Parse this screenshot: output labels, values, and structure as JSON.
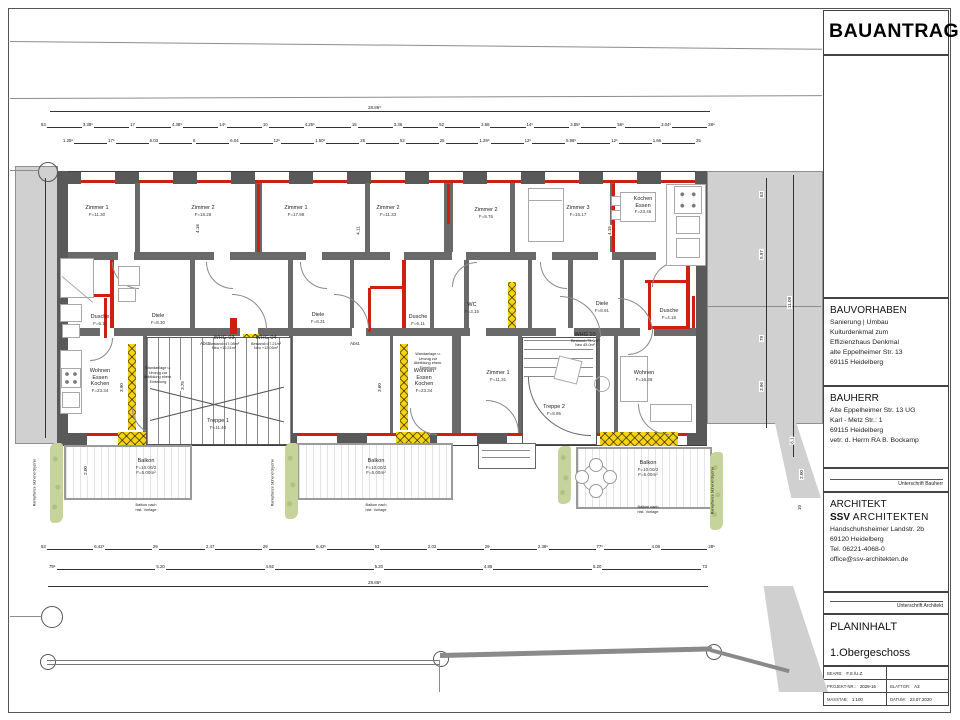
{
  "colors": {
    "wall": "#595959",
    "new_wall_red": "#cf1f10",
    "demolition_yellow": "#f6d412",
    "neighbor_gray": "#d0d0d0",
    "plant_green": "#c6d49c"
  },
  "title_block": {
    "title": "BAUANTRAG",
    "bauvorhaben": {
      "heading": "BAUVORHABEN",
      "lines": [
        "Sanierung | Umbau",
        "Kulturdenkmal zum",
        "Effizienzhaus Denkmal",
        "alte Eppelheimer Str. 13",
        "69115 Heidelberg"
      ]
    },
    "bauherr": {
      "heading": "BAUHERR",
      "lines": [
        "Alte Eppelheimer Str. 13 UG",
        "Karl - Metz Str.: 1",
        "69115 Heidelberg",
        "vetr. d. Herrn RA B. Bockamp"
      ]
    },
    "unterschrift_bauherr": "Unterschrift Bauherr",
    "architekt": {
      "heading": "ARCHITEKT",
      "firm_bold": "SSV",
      "firm_rest": "ARCHITEKTEN",
      "lines": [
        "Handschuhsheimer Landstr. 2b",
        "69120 Heidelberg",
        "Tel. 06221-4068-0",
        "office@ssv-architekten.de"
      ]
    },
    "unterschrift_architekt": "Unterschrift Architekt",
    "planinhalt": {
      "heading": "PLANINHALT",
      "value": "1.Obergeschoss"
    },
    "table": {
      "bearb_label": "BEARB:",
      "bearb_value": "F.S./U.Z.",
      "projekt_label": "PROJEKT-NR.:",
      "projekt_value": "2029-16",
      "blatt_label": "BLATTGR:",
      "blatt_value": "A3",
      "masstab_label": "MASSTAB:",
      "masstab_value": "1:100",
      "datum_label": "DATUM:",
      "datum_value": "23.07.2020"
    }
  },
  "plan": {
    "rooms": [
      {
        "name1": "Zimmer 1",
        "area": "F=11.30"
      },
      {
        "name1": "Zimmer 2",
        "area": "F=18.28"
      },
      {
        "name1": "Zimmer 1",
        "area": "F=17.98"
      },
      {
        "name1": "Zimmer 2",
        "area": "F=11.33"
      },
      {
        "name1": "Zimmer 2",
        "area": "F=9.76"
      },
      {
        "name1": "Zimmer 3",
        "area": "F=15.17"
      },
      {
        "name1": "Kochen",
        "name2": "Essen",
        "area": "F=23.45"
      },
      {
        "name1": "Dusche",
        "area": "F=6.11"
      },
      {
        "name1": "Diele",
        "area": "F=8.30"
      },
      {
        "name1": "Diele",
        "area": "F=8.31"
      },
      {
        "name1": "Dusche",
        "area": "F=6.11"
      },
      {
        "name1": "WC",
        "area": "F=3.15"
      },
      {
        "name1": "Diele",
        "area": "F=8.91"
      },
      {
        "name1": "Dusche",
        "area": "F=4.18"
      },
      {
        "name1": "Wohnen",
        "name2": "Essen",
        "name3": "Kochen",
        "area": "F=23.34"
      },
      {
        "name1": "Treppe 1",
        "area": "F=11.40"
      },
      {
        "name1": "Wohnen",
        "name2": "Essen",
        "name3": "Kochen",
        "area": "F=23.34"
      },
      {
        "name1": "Zimmer 1",
        "area": "F=11.31"
      },
      {
        "name1": "Treppe 2",
        "area": "F=8.95"
      },
      {
        "name1": "Wohnen",
        "area": "F=16.38"
      }
    ],
    "wohnungen": [
      {
        "name": "WHG 03",
        "l1": "Bestand=47.08m²",
        "l2": "Neu  +10.21m²"
      },
      {
        "name": "WHG 04",
        "l1": "Bestand=47.21m²",
        "l2": "Neu  +12.03m²"
      },
      {
        "name": "WHG 10",
        "l1": "Bestand=75.6m²",
        "l2": "Neu  45.0m²"
      }
    ],
    "balkon": {
      "name": "Balkon",
      "l1": "F=10.00/2",
      "l2": "F=5.00m²",
      "note1": "Balkon nach",
      "note2": "hist. Vorlage"
    },
    "abst": "Abst.",
    "wand_note": [
      "Wandanlage u.",
      "Umzug zur",
      "Abbildung ehem.",
      "Einteilung"
    ],
    "plant_note": "Rankpflanze blühend Glyzinie",
    "dims": {
      "total": "28.86⁵",
      "top_row1": [
        "53",
        "3.38⁵",
        "17",
        "4.38⁵",
        "14⁵",
        "10",
        "4.25⁵",
        "15",
        "3.36",
        "52",
        "2.88",
        "14⁵",
        "3.85⁵",
        "56⁵",
        "3.04⁵",
        "28⁵"
      ],
      "top_row2": [
        "1.25⁵",
        "17⁵",
        "6.03",
        "6",
        "6.04",
        "12⁵",
        "1.50⁵",
        "25",
        "52",
        "25",
        "1.29⁵",
        "12⁵",
        "5.98⁵",
        "12⁵",
        "1.66",
        "25"
      ],
      "bottom_row1": [
        "53",
        "6.42⁵",
        "29",
        "2.47",
        "29",
        "6.42⁵",
        "53",
        "2.02",
        "29",
        "2.36⁵",
        "77⁵",
        "4.08",
        "28⁵"
      ],
      "bottom_row2": [
        "79⁵",
        "5.20",
        "4.92",
        "5.20",
        "4.85",
        "5.20",
        "73"
      ],
      "right_col": [
        "63",
        "5.97",
        "11.08",
        "79",
        "3.96",
        "6.1",
        "2.00",
        "10"
      ],
      "interior": [
        "4.16",
        "4.11",
        "4.15",
        "3.90",
        "3.75",
        "3.60",
        "2.00",
        "2.00"
      ]
    }
  }
}
